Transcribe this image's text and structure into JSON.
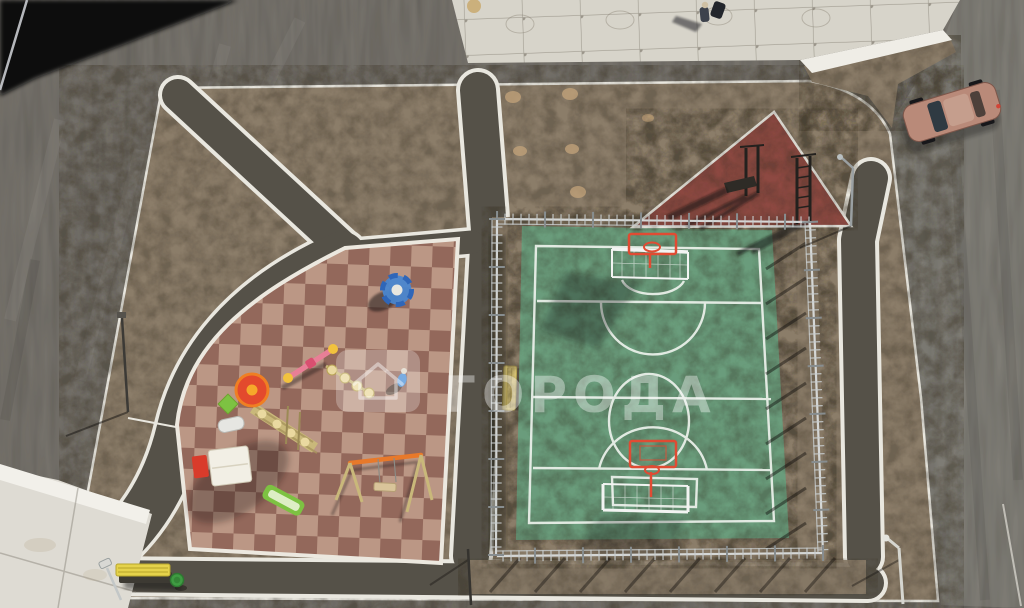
{
  "meta": {
    "type": "aerial-drone-photo",
    "subject": "Top-down view of a new residential courtyard: fenced green sports court, checkerboard rubber playground, triangular red workout pad, asphalt footpaths with white edge lines, dirt planting areas, parked car and pedestrian"
  },
  "watermark": {
    "text": "ГОРОДА",
    "logo": "house-in-rounded-square"
  },
  "objects": {
    "sports_court": "green mini-football court with white markings, two white goals with red basketball hoops, mesh fence",
    "playground": "brown-tan checkerboard rubber playground with tower complex, slide, carousel, seesaw and swing",
    "workout_area": "triangular dark-red rubber pad with two dark metal workout stations",
    "car": "pink-beige hatchback parked on road, top right",
    "pedestrian": "person with stroller on concrete pavement, top edge",
    "child": "child in blue on playground",
    "bench": "yellow bench with green litter bin on bottom path",
    "building_shadow": "black building shadow in top-left corner",
    "lamps": "street lamp poles around the courtyard"
  },
  "colors": {
    "base_asphalt": "#74716b",
    "road_right": "#7e7b75",
    "dirt": "#8b7d69",
    "dirt_spot": "#c4a47b",
    "path_asphalt": "#555148",
    "line_white": "#e9e7df",
    "pavement": "#d7d4ca",
    "curb": "#efede6",
    "slab": "#dedbd3",
    "shadow_black": "#090b0f",
    "court_green": "#6b9c7c",
    "court_line": "#edf2ec",
    "tile_dark": "#93685b",
    "tile_light": "#bb9785",
    "playground_edge": "#ece8df",
    "triangle_red": "#8d4a42",
    "carousel_blue": "#4a86cf",
    "carousel_blue_dark": "#2f66b8",
    "bench_yellow": "#e5d24b",
    "bin_green": "#3f9b42",
    "swing_orange": "#e8792a",
    "roof_red": "#e34a2d",
    "roof_orange": "#ef7f23",
    "slide_green": "#7dc242",
    "box_cream": "#f2efe5",
    "box_red": "#d93b2b",
    "seesaw_pink": "#e87f96",
    "seesaw_yellow": "#f2c23e",
    "khaki": "#c9b87a",
    "khaki_light": "#ead9a0",
    "car_body": "#b98a79",
    "car_roof": "#c59e8d",
    "car_glass": "#2f3a42",
    "metal_dark": "#23211e",
    "fence_rail": "#dadddd",
    "fence_tick": "#c7cccd",
    "fence_post": "#878d8f",
    "hoop_red": "#e04b33",
    "goal_white": "#f2f4f2",
    "watermark_white": "#ffffff"
  }
}
